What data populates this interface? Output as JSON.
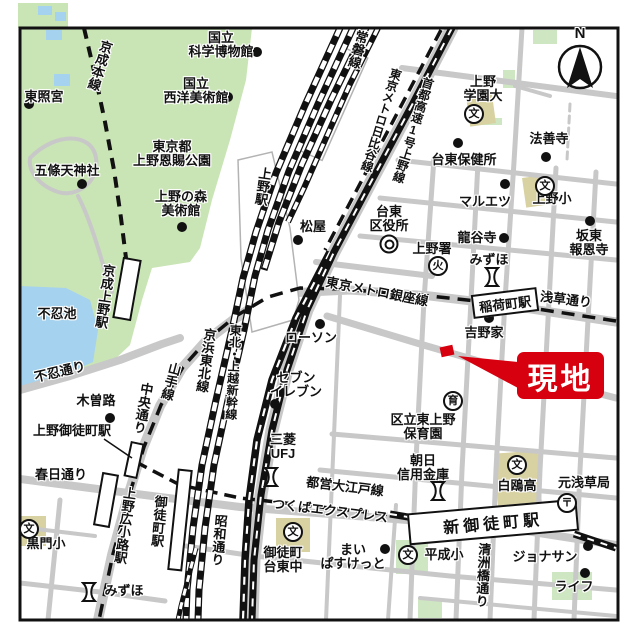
{
  "places": {
    "toshogu": "東照宮",
    "kagaku1": "国立",
    "kagaku2": "科学博物館",
    "seiyo1": "国立",
    "seiyo2": "西洋美術館",
    "onshi1": "東京都",
    "onshi2": "上野恩賜公園",
    "gojoten": "五條天神社",
    "mori1": "上野の森",
    "mori2": "美術館",
    "shinobazu_pond": "不忍池",
    "kisoji": "木曽路",
    "matsuya": "松屋",
    "kuyakusho1": "台東",
    "kuyakusho2": "区役所",
    "uenosho": "上野署",
    "ryukokuji": "龍谷寺",
    "mizuho": "みずほ",
    "maruetsu": "マルエツ",
    "hokenjo": "台東保健所",
    "gakuen1": "上野",
    "gakuen2": "学園大",
    "hozenji": "法善寺",
    "ueno_elem": "上野小",
    "bando1": "坂東",
    "bando2": "報恩寺",
    "yoshinoya": "吉野家",
    "lawson": "ローソン",
    "seven1": "セブン",
    "seven2": "イレブン",
    "ufj1": "三菱",
    "ufj2": "UFJ",
    "hoikuen1": "区立東上野",
    "hoikuen2": "保育園",
    "asahi1": "朝日",
    "asahi2": "信用金庫",
    "hakuo": "白鴎高",
    "motoasakusa": "元浅草局",
    "heisei": "平成小",
    "maibasu1": "まい",
    "maibasu2": "ぱすけっと",
    "taitochu1": "御徒町",
    "taitochu2": "台東中",
    "jonathan": "ジョナサン",
    "life": "ライフ",
    "kuromon": "黒門小"
  },
  "roads": {
    "shinobazu": "不忍通り",
    "chuo": "中央通り",
    "kasuga": "春日通り",
    "showa": "昭和通り",
    "asakusa": "浅草通り",
    "kiyosubashi": "清洲橋通り"
  },
  "rails": {
    "keisei": "京成本線",
    "joban": "常磐線",
    "hibiya": "東京メトロ日比谷線",
    "shuto": "首都高速1号上野線",
    "ginza": "東京メトロ銀座線",
    "yamanote": "山手線",
    "keihin": "京浜東北線",
    "shinkansen": "東北・上越新幹線",
    "oedo": "都営大江戸線",
    "tx": "つくばエクスプレス"
  },
  "stations": {
    "ueno": "上野駅",
    "keisei_ueno": "京成上野駅",
    "ueno_okachimachi": "上野御徒町駅",
    "hirokoji": "上野広小路駅",
    "okachimachi": "御徒町駅",
    "inaricho": "稲荷町駅",
    "shin_okachimachi": "新御徒町駅"
  },
  "symbols": {
    "school": "文",
    "fire": "火",
    "nursery": "育",
    "post": "〒"
  },
  "callout": {
    "label": "現地"
  },
  "compass": {
    "label": "N"
  },
  "colors": {
    "park": "#c9e4b5",
    "water": "#a5d2ee",
    "road": "#c8c8c8",
    "building": "#d8d1a2",
    "green_building": "#cfe6c2",
    "red": "#d7000f"
  }
}
